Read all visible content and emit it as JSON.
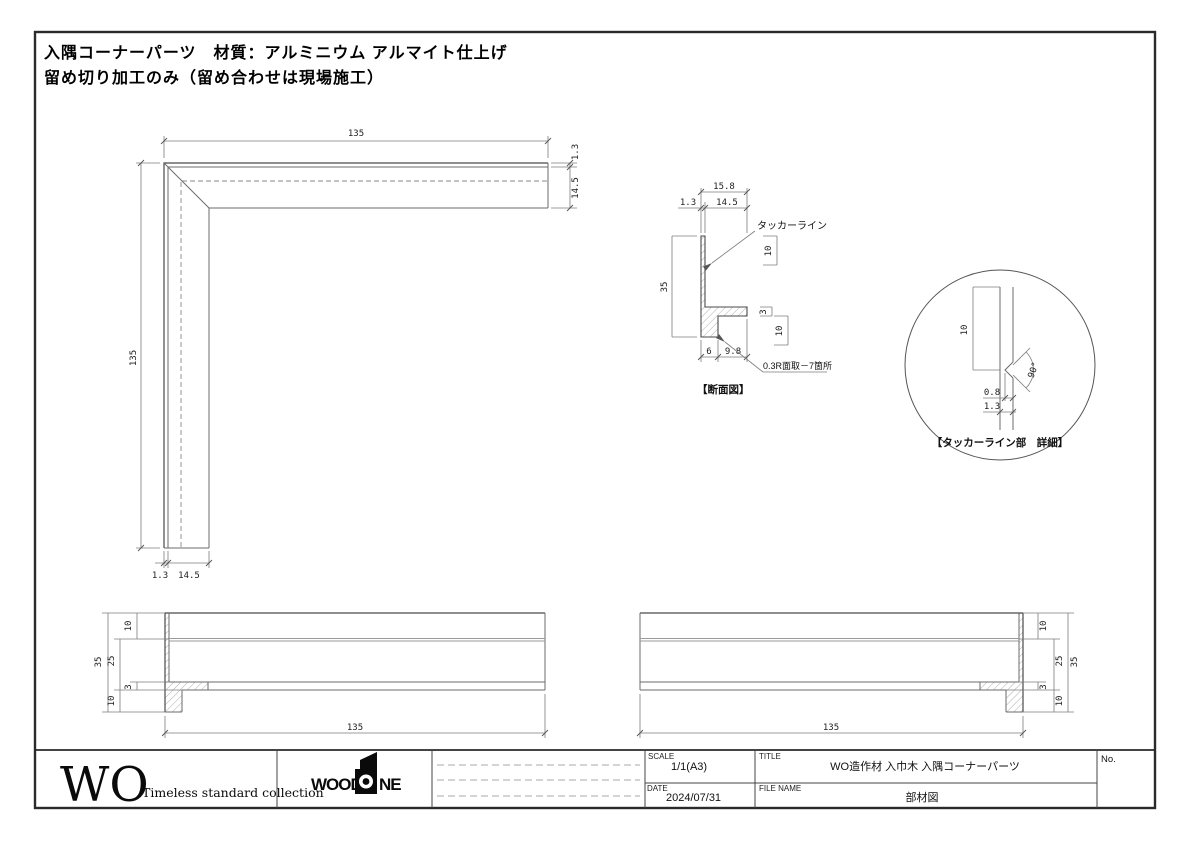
{
  "page": {
    "background": "#ffffff",
    "line_color": "#6b6b6b",
    "text_color": "#111111",
    "note_line1": "入隅コーナーパーツ　材質：アルミニウム アルマイト仕上げ",
    "note_line2": "留め切り加工のみ（留め合わせは現場施工）"
  },
  "plan_view": {
    "dim_top": "135",
    "dim_left": "135",
    "dim_right_outer": "1.3",
    "dim_right_inner": "14.5",
    "dim_bottom_outer": "1.3",
    "dim_bottom_inner": "14.5"
  },
  "section_view": {
    "caption": "【断面図】",
    "dim_total_width": "15.8",
    "dim_web_thickness": "1.3",
    "dim_inner_width": "14.5",
    "dim_height": "35",
    "dim_tacker_from_top": "10",
    "dim_flange_thickness": "3",
    "dim_flange_zone": "10",
    "dim_foot_width": "6",
    "dim_flange_reach": "9.8",
    "tacker_label": "タッカーライン",
    "chamfer_note": "0.3R面取－7箇所"
  },
  "detail_view": {
    "caption": "【タッカーライン部　詳細】",
    "dim_from_top": "10",
    "dim_groove_depth": "0.8",
    "dim_web_thickness": "1.3",
    "angle_label": "90°"
  },
  "elevation_left": {
    "dim_length": "135",
    "dim_height": "35",
    "dim_upper": "10",
    "dim_mid": "25",
    "dim_flange": "3",
    "dim_lower": "10"
  },
  "elevation_right": {
    "dim_length": "135",
    "dim_height": "35",
    "dim_upper": "10",
    "dim_mid": "25",
    "dim_flange": "3",
    "dim_lower": "10"
  },
  "title_block": {
    "wo_logo": "WO",
    "wo_tagline": "Timeless standard collection",
    "brand_left": "WOOD",
    "brand_right": "NE",
    "scale_label": "SCALE",
    "scale_value": "1/1(A3)",
    "date_label": "DATE",
    "date_value": "2024/07/31",
    "title_label": "TITLE",
    "title_value": "WO造作材 入巾木 入隅コーナーパーツ",
    "file_label": "FILE NAME",
    "file_value": "部材図",
    "no_label": "No."
  }
}
